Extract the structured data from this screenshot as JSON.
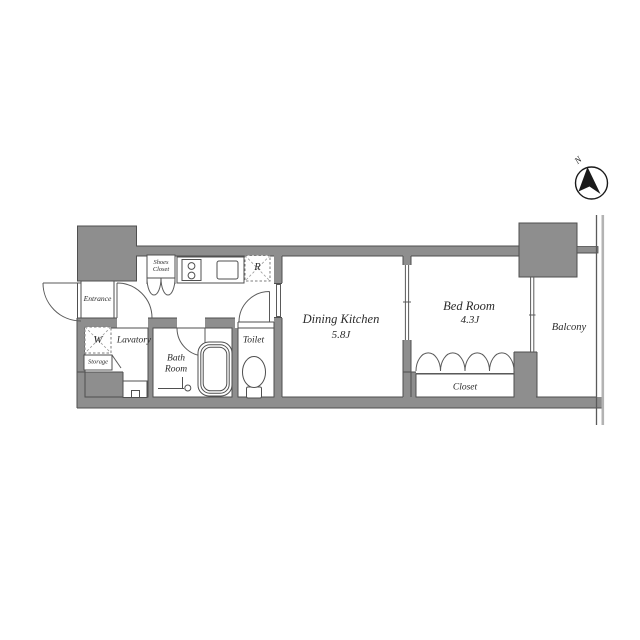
{
  "title": "apartment-floor-plan",
  "colors": {
    "wall_fill": "#8e8e8e",
    "line": "#4f4f4f",
    "dashed_box": "#7d7d7d",
    "text": "#2b2b2b",
    "compass_ink": "#1a1a1a",
    "boundary_light": "#b3b3b3",
    "background": "#ffffff"
  },
  "compass": {
    "north_label": "N"
  },
  "rooms": {
    "entrance": {
      "label": "Entrance"
    },
    "shoes_closet": {
      "label": "Shoes Closet"
    },
    "storage": {
      "label": "Storage"
    },
    "washing_machine": {
      "label": "W"
    },
    "lavatory": {
      "label": "Lavatory"
    },
    "bath_room": {
      "label": "Bath Room"
    },
    "toilet": {
      "label": "Toilet"
    },
    "refrigerator": {
      "label": "R"
    },
    "dining_kitchen": {
      "label": "Dining Kitchen",
      "area": "5.8J"
    },
    "bed_room": {
      "label": "Bed Room",
      "area": "4.3J"
    },
    "closet": {
      "label": "Closet"
    },
    "balcony": {
      "label": "Balcony"
    }
  }
}
